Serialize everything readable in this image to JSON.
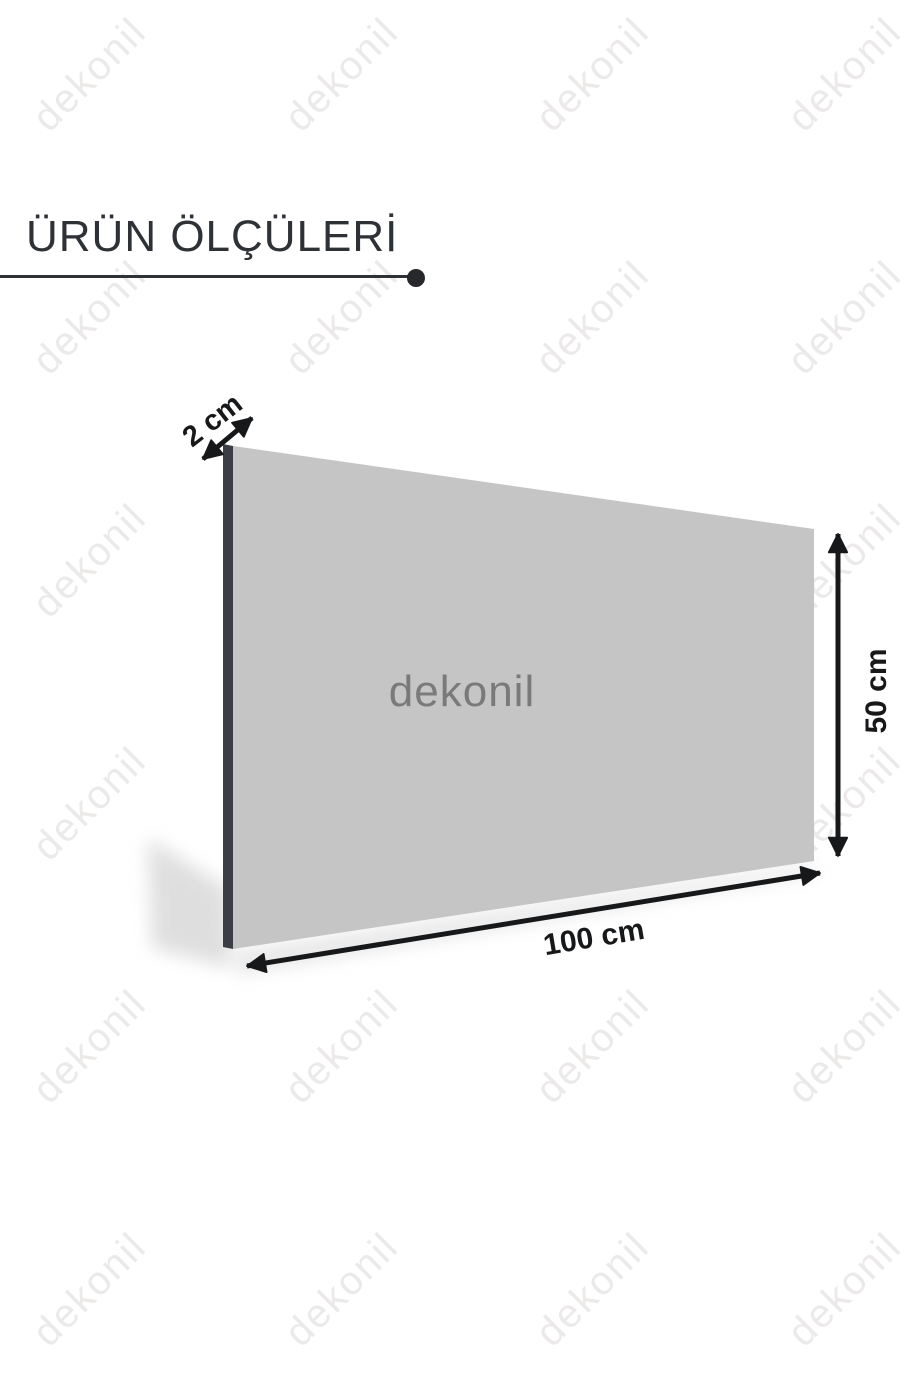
{
  "title": {
    "text": "ÜRÜN ÖLÇÜLERİ"
  },
  "watermark": {
    "text": "dekonil",
    "color": "#ece9e9"
  },
  "panel": {
    "brand": "dekonil",
    "face_color": "#c5c5c6",
    "edge_color": "#3b3e44",
    "brand_color": "#7a7a7b"
  },
  "dimensions": {
    "thickness": "2 cm",
    "height": "50 cm",
    "width": "100 cm"
  },
  "accent": {
    "arrow_color": "#17181a",
    "title_color": "#2e3136"
  }
}
